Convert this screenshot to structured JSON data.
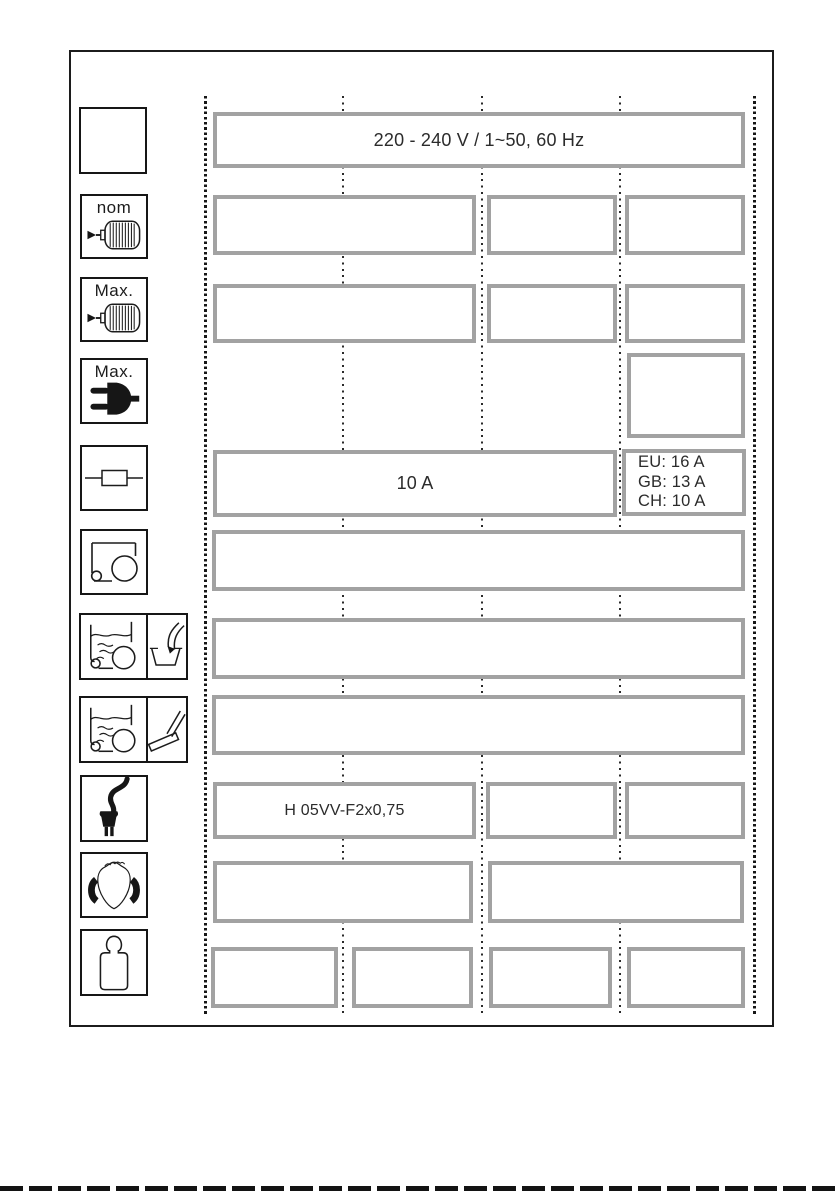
{
  "page": {
    "kind": "appliance-technical-data-sheet"
  },
  "icons": [
    {
      "name": "blank-box",
      "label": ""
    },
    {
      "name": "motor-nominal-icon",
      "label": "nom"
    },
    {
      "name": "motor-max-icon",
      "label": "Max."
    },
    {
      "name": "plug-max-icon",
      "label": "Max."
    },
    {
      "name": "fuse-icon",
      "label": ""
    },
    {
      "name": "vacuum-cleaner-icon",
      "label": ""
    },
    {
      "name": "wet-pickup-container-icon",
      "label": ""
    },
    {
      "name": "wet-pickup-floor-icon",
      "label": ""
    },
    {
      "name": "power-cord-icon",
      "label": ""
    },
    {
      "name": "hearing-sound-icon",
      "label": ""
    },
    {
      "name": "weight-icon",
      "label": ""
    }
  ],
  "specs": {
    "voltage": "220 - 240 V / 1~50, 60 Hz",
    "fuse": "10 A",
    "fuse_regional": [
      "EU: 16 A",
      "GB: 13 A",
      "CH: 10 A"
    ],
    "cable": "H 05VV-F2x0,75"
  },
  "colors": {
    "box_border": "#a2a2a2",
    "line_black": "#1c1c1c",
    "background": "#ffffff"
  }
}
